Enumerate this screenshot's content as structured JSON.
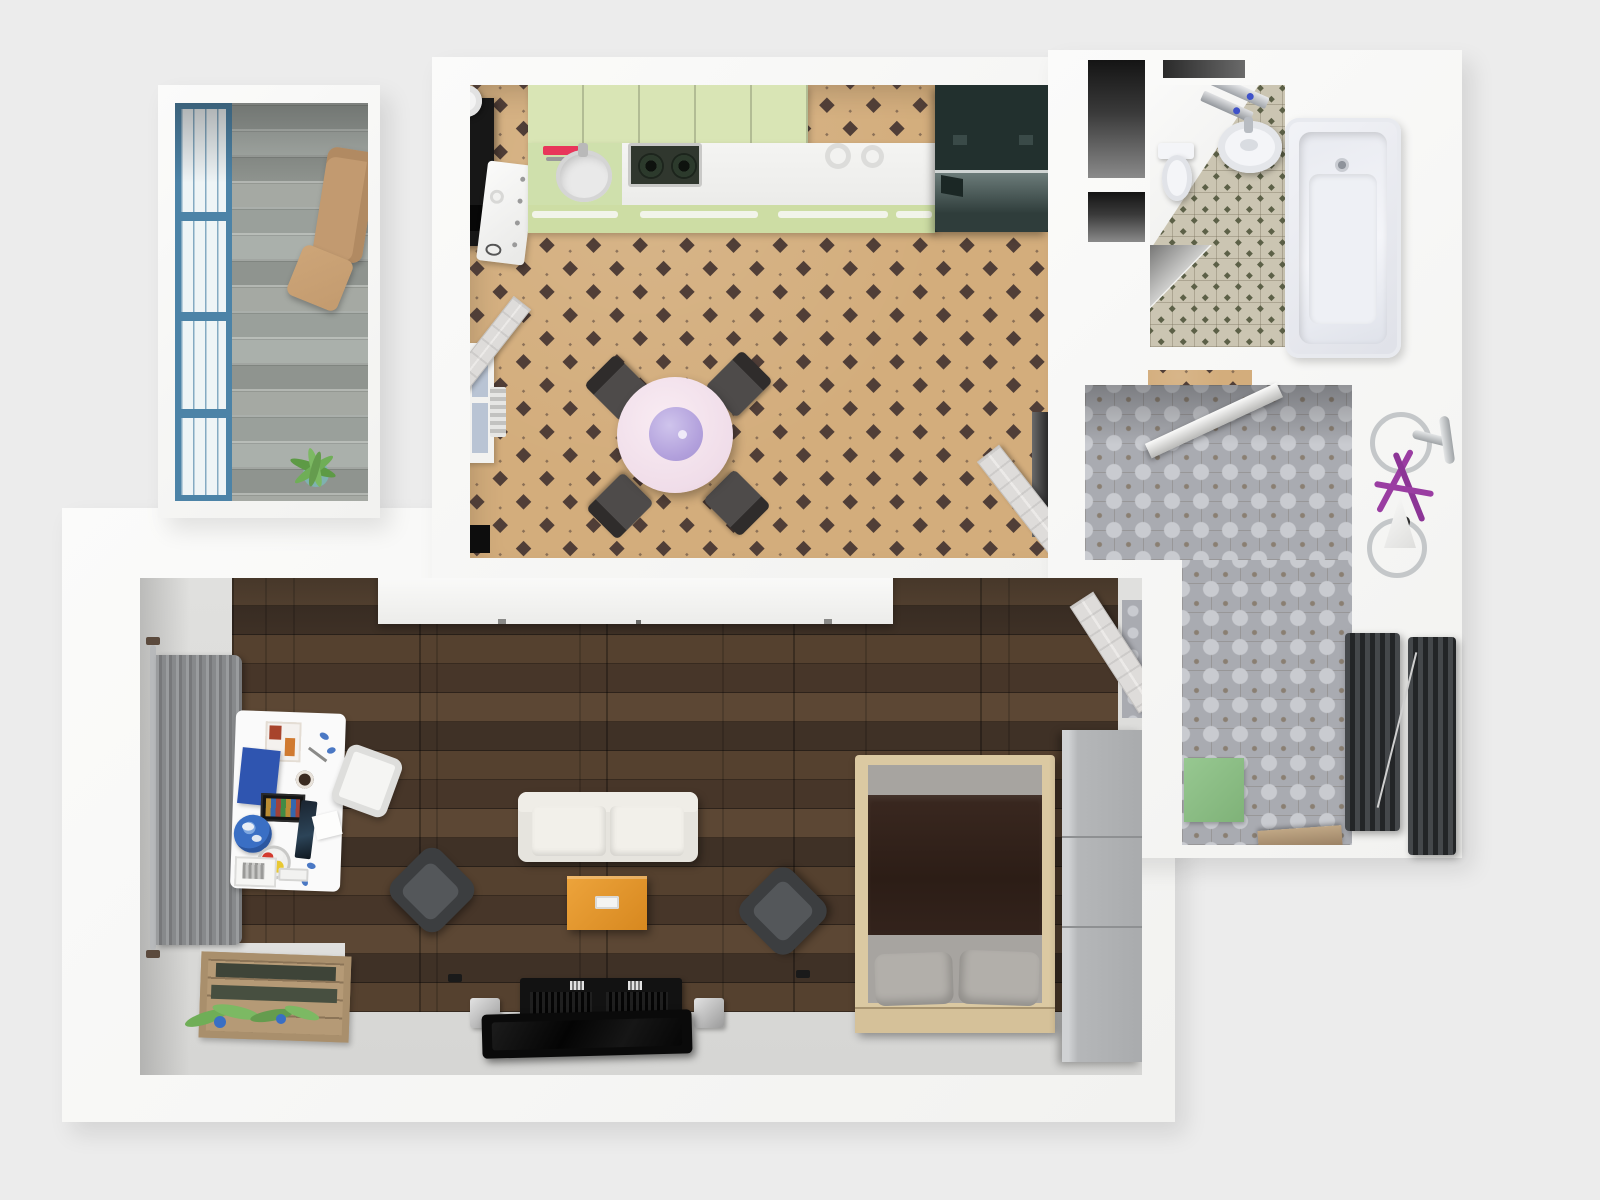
{
  "title": "3D apartment floor plan, top-down view",
  "palette": {
    "background": "#ececec",
    "wall": "#f8f8f7",
    "balcony_floor": "#a3a7a2",
    "window_frame": "#4c83a7",
    "kitchen_floor": "#d3ad7c",
    "kitchen_tile_accent": "#503e37",
    "cabinet_green": "#d9e5b5",
    "counter_white": "#f2f2f0",
    "fridge_dark": "#2c3a38",
    "table_pink": "#f4e3ec",
    "table_center_lavender": "#b7a6de",
    "dining_chair_dark": "#4a4746",
    "bath_tile": "#cbc5b2",
    "bath_tile_accent": "#5c6047",
    "fixture_white": "#f4f5f8",
    "hall_tile": "#a9abb1",
    "bike_purple": "#9a3da2",
    "radiator_dark": "#35373a",
    "doormat_green": "#8cbf85",
    "step_wood": "#b09877",
    "living_wood": "#4a392c",
    "sofa_cream": "#eceae4",
    "coffee_table_orange": "#e09030",
    "armchair_dark": "#3c3e40",
    "tv_black": "#111111",
    "speaker_silver": "#c9c9c9",
    "bed_frame": "#dbc9a2",
    "blanket_brown": "#33231c",
    "bedding_gray": "#a7a4a0",
    "wardrobe_gray": "#b5b7b9",
    "curtain_gray": "#87898b",
    "desk_white": "#fafafa",
    "crate_wood": "#b59a76",
    "plant_green": "#6fae57"
  },
  "rooms": {
    "balcony": {
      "label": "Balcony",
      "items": {
        "window": "Blue-framed window wall",
        "armchair": "Tan armchair",
        "pouf": "Tan pouf",
        "plant": "Potted plant",
        "floor": "Weathered gray plank floor"
      }
    },
    "kitchen": {
      "label": "Kitchen and dining room",
      "items": {
        "upper_cabinets": "Pale green cabinet row",
        "counter": "White countertop",
        "sink": "Round kitchen sink",
        "cutting_board": "Red cutting board",
        "hob": "Two-burner gas hob",
        "dishes": "Two white dishes",
        "fridge": "Dark fridge-freezer",
        "coffee_station": "Black shelf with espresso machine",
        "drawer_unit": "White drawer cabinet",
        "window": "Window with radiator below",
        "trash_bin": "Black waste bin",
        "balcony_door": "Open door by balcony wall",
        "hall_door": "Open door to hallway",
        "dining_table": "Round pastel-pink dining table",
        "table_centerpiece": "Lavender centerpiece bowl",
        "dining_chairs": "Four dark dining chairs",
        "floor": "Beige tile floor with dark diamond accents"
      }
    },
    "bathroom": {
      "label": "Bathroom",
      "items": {
        "bathtub": "White bathtub",
        "sink": "Round washbasin",
        "shelf": "Chrome shelf with bottles",
        "toilet": "Toilet with cistern",
        "niche": "Dark door niches",
        "floor": "Beige tile floor with olive diamond dots"
      }
    },
    "hallway": {
      "label": "Hallway",
      "items": {
        "bicycle": "Purple wall-mounted bicycle",
        "lamp": "White cone lamp",
        "radiator_a": "Dark vertical radiator",
        "radiator_b": "Dark vertical radiator",
        "doormat": "Green doormat",
        "step": "Wooden threshold step",
        "bath_door": "Open door to bathroom",
        "floor": "Ornamental gray tile floor"
      }
    },
    "living_room": {
      "label": "Living room and bedroom",
      "items": {
        "sideboard": "Long white sideboard",
        "curtain": "Gray curtain on wall rod",
        "desk": "White desk with accessories",
        "desk_chair": "White desk chair",
        "planter": "Wooden crate planter with plants",
        "sofa": "Cream two-seat sofa",
        "coffee_table": "Orange coffee table with remote",
        "armchair_left": "Dark armchair",
        "armchair_right": "Dark armchair",
        "tv_console": "Black TV lowboard",
        "speaker_left": "Silver speaker",
        "speaker_right": "Silver speaker",
        "tv": "Flat TV panel",
        "bed": "Double bed with brown blanket and gray pillows",
        "wardrobe": "Gray three-section wardrobe",
        "entry_door": "Open door to hallway",
        "floor": "Dark walnut plank floor"
      }
    }
  }
}
